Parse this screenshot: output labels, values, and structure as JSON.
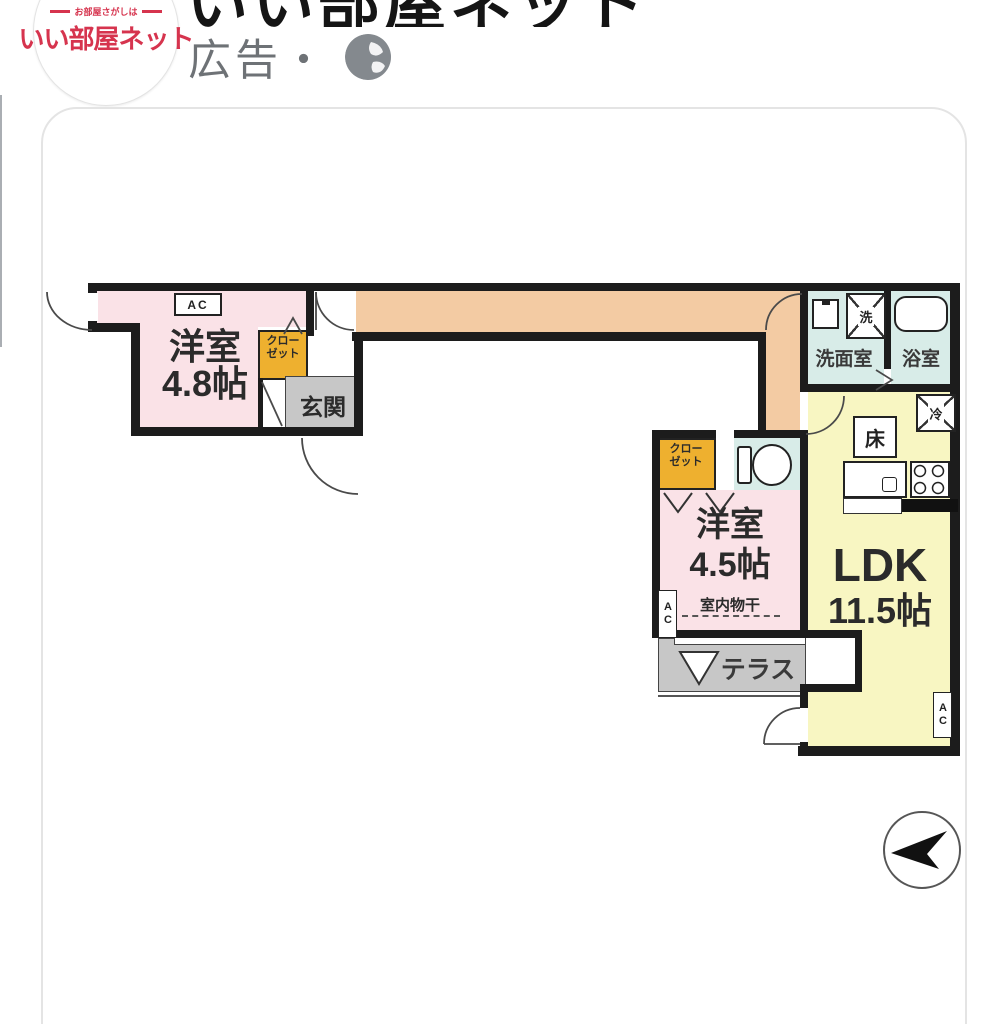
{
  "header": {
    "logo_tagline": "お部屋さがしは",
    "logo_brand": "いい部屋ネット",
    "title": "いい部屋ネット",
    "ad_label": "広告・"
  },
  "floorplan": {
    "rooms": {
      "western48": {
        "name": "洋室",
        "size": "4.8帖"
      },
      "western45": {
        "name": "洋室",
        "size": "4.5帖"
      },
      "ldk": {
        "name": "LDK",
        "size": "11.5帖"
      },
      "entrance": "玄関",
      "washroom": "洗面室",
      "bathroom": "浴室",
      "terrace": "テラス",
      "indoor_drying": "室内物干",
      "closet1": {
        "line1": "クロー",
        "line2": "ゼット"
      },
      "closet2": {
        "line1": "クロー",
        "line2": "ゼット"
      }
    },
    "labels": {
      "ac": "AC",
      "washer": "洗",
      "fridge": "冷",
      "floor_storage": "床"
    },
    "colors": {
      "hall": "#f3cba3",
      "western_room": "#fae2e7",
      "ldk": "#f8f6c2",
      "wet_area": "#d8ece8",
      "closet": "#eeb02f",
      "gray_area": "#c7c7c7",
      "wall": "#1c1c1c",
      "brand_red": "#d6344e"
    }
  }
}
